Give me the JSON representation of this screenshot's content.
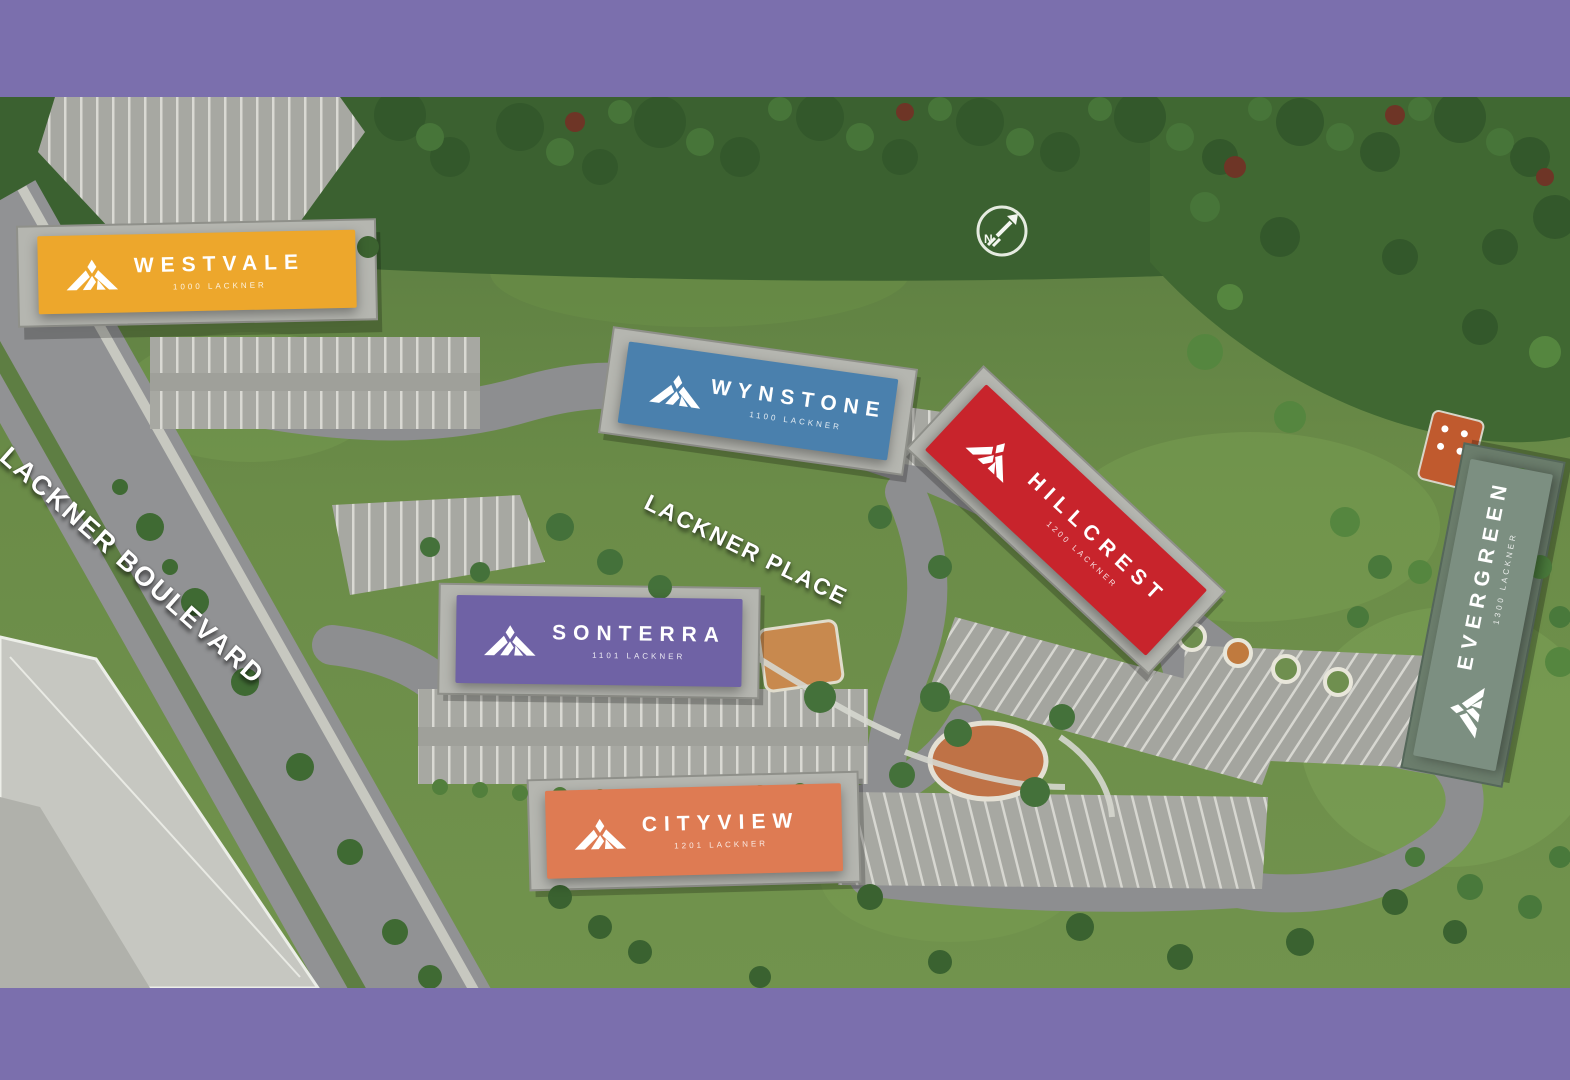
{
  "frame": {
    "border_color": "#7b6fad"
  },
  "terrain_colors": {
    "grass": "#67874a",
    "forest": "#3b6130",
    "road": "#919294",
    "parking": "#a7a8a2"
  },
  "map": {
    "streets": [
      {
        "label": "LACKNER BOULEVARD"
      },
      {
        "label": "LACKNER PLACE"
      }
    ],
    "compass": {
      "label": "N"
    },
    "buildings": [
      {
        "id": "westvale",
        "name": "WESTVALE",
        "subtitle": "1000 LACKNER",
        "color": "#eda72c"
      },
      {
        "id": "wynstone",
        "name": "WYNSTONE",
        "subtitle": "1100 LACKNER",
        "color": "#4a80ad"
      },
      {
        "id": "hillcrest",
        "name": "HILLCREST",
        "subtitle": "1200 LACKNER",
        "color": "#c8242c"
      },
      {
        "id": "sonterra",
        "name": "SONTERRA",
        "subtitle": "1101 LACKNER",
        "color": "#6f62a5"
      },
      {
        "id": "cityview",
        "name": "CITYVIEW",
        "subtitle": "1201 LACKNER",
        "color": "#de7b53"
      },
      {
        "id": "evergreen",
        "name": "EVERGREEN",
        "subtitle": "1300 LACKNER",
        "color": "#7c8f81"
      }
    ]
  }
}
